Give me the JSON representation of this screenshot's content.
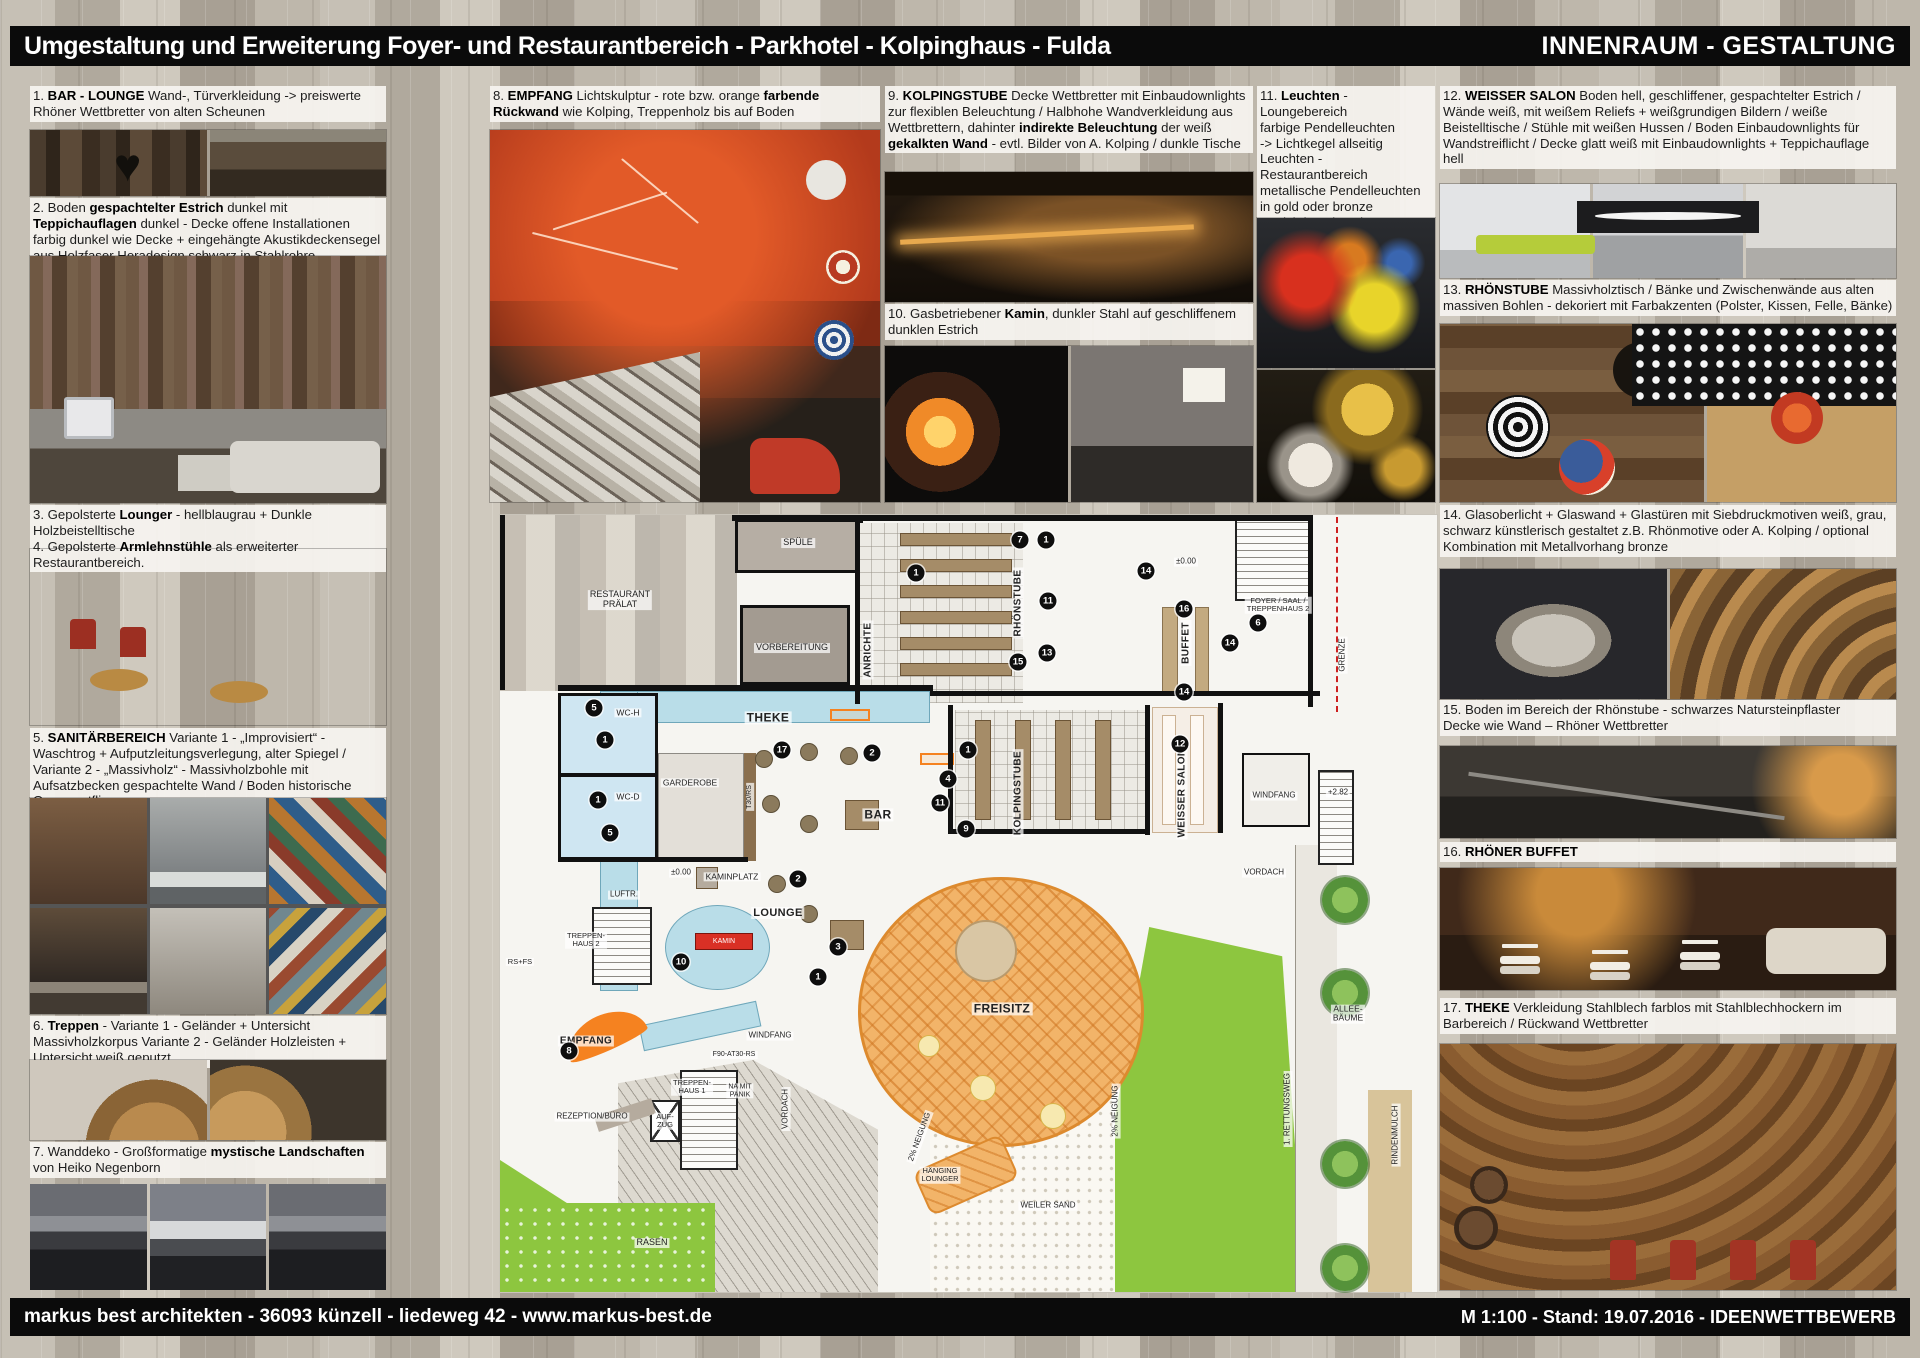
{
  "header": {
    "title": "Umgestaltung und Erweiterung Foyer- und Restaurantbereich - Parkhotel - Kolpinghaus - Fulda",
    "right_title": "INNENRAUM - GESTALTUNG"
  },
  "footer": {
    "left": "markus best architekten - 36093 künzell - liedeweg 42 - www.markus-best.de",
    "right": "M 1:100   -   Stand: 19.07.2016   -   IDEENWETTBEWERB"
  },
  "colors": {
    "accent_orange": "#f58220",
    "plan_cyan": "#b9dde8",
    "plan_green": "#8dc63f",
    "kamin_red": "#d93025",
    "marker_black": "#0e0e0e"
  },
  "annotations": [
    {
      "segments": [
        {
          "b": false,
          "t": "1. "
        },
        {
          "b": true,
          "t": "BAR - LOUNGE"
        },
        {
          "b": false,
          "t": " Wand-, Türverkleidung -> preiswerte Rhöner Wettbretter von alten Scheunen"
        }
      ]
    },
    {
      "segments": [
        {
          "b": false,
          "t": "2. Boden "
        },
        {
          "b": true,
          "t": "gespachtelter Estrich"
        },
        {
          "b": false,
          "t": " dunkel mit "
        },
        {
          "b": true,
          "t": "Teppichauflagen"
        },
        {
          "b": false,
          "t": " dunkel - Decke offene Installationen farbig dunkel wie Decke + eingehängte Akustikdeckensegel aus Holzfaser Heradesign schwarz in Stahlrohre"
        }
      ]
    },
    {
      "segments": [
        {
          "b": false,
          "t": "3. Gepolsterte "
        },
        {
          "b": true,
          "t": "Lounger"
        },
        {
          "b": false,
          "t": " - hellblaugrau + Dunkle Holzbeistelltische\n4. Gepolsterte "
        },
        {
          "b": true,
          "t": "Armlehnstühle"
        },
        {
          "b": false,
          "t": " als erweiterter Restaurantbereich."
        }
      ]
    },
    {
      "segments": [
        {
          "b": false,
          "t": "5. "
        },
        {
          "b": true,
          "t": "SANITÄRBEREICH"
        },
        {
          "b": false,
          "t": " Variante 1 - „Improvisiert“ - Waschtrog + Aufputzleitungsverlegung, alter Spiegel / Variante 2 - „Massivholz“ - Massivholzbohle mit Aufsatzbecken gespachtelte Wand / Boden historische Ornamentfliesen"
        }
      ]
    },
    {
      "segments": [
        {
          "b": false,
          "t": "6. "
        },
        {
          "b": true,
          "t": "Treppen"
        },
        {
          "b": false,
          "t": " - Variante 1 - Geländer + Untersicht Massivholzkorpus Variante 2 - Geländer Holzleisten + Untersicht weiß geputzt"
        }
      ]
    },
    {
      "segments": [
        {
          "b": false,
          "t": "7. Wanddeko - Großformatige "
        },
        {
          "b": true,
          "t": "mystische Landschaften"
        },
        {
          "b": false,
          "t": " von Heiko Negenborn"
        }
      ]
    },
    {
      "segments": [
        {
          "b": false,
          "t": "8. "
        },
        {
          "b": true,
          "t": "EMPFANG"
        },
        {
          "b": false,
          "t": " Lichtskulptur - rote bzw. orange "
        },
        {
          "b": true,
          "t": "farbende Rückwand"
        },
        {
          "b": false,
          "t": " wie Kolping, Treppenholz bis auf Boden"
        }
      ]
    },
    {
      "segments": [
        {
          "b": false,
          "t": "9. "
        },
        {
          "b": true,
          "t": "KOLPINGSTUBE"
        },
        {
          "b": false,
          "t": " Decke Wettbretter mit Einbaudownlights zur flexiblen Beleuchtung / Halbhohe Wandverkleidung aus Wettbrettern, dahinter "
        },
        {
          "b": true,
          "t": "indirekte Beleuchtung"
        },
        {
          "b": false,
          "t": " der weiß "
        },
        {
          "b": true,
          "t": "gekalkten Wand"
        },
        {
          "b": false,
          "t": " - evtl. Bilder von A. Kolping / dunkle Tische"
        }
      ]
    },
    {
      "segments": [
        {
          "b": false,
          "t": "10. Gasbetriebener "
        },
        {
          "b": true,
          "t": "Kamin"
        },
        {
          "b": false,
          "t": ", dunkler Stahl auf geschliffenem dunklen Estrich"
        }
      ]
    },
    {
      "segments": [
        {
          "b": false,
          "t": "11. "
        },
        {
          "b": true,
          "t": "Leuchten"
        },
        {
          "b": false,
          "t": " - Loungebereich\nfarbige Pendelleuchten\n-> Lichtkegel allseitig\nLeuchten - Restaurantbereich\nmetallische Pendelleuchten\nin gold oder bronze\n-> Lichtkegel nach unten"
        }
      ]
    },
    {
      "segments": [
        {
          "b": false,
          "t": "12. "
        },
        {
          "b": true,
          "t": "WEISSER SALON"
        },
        {
          "b": false,
          "t": " Boden hell, geschliffener, gespachtelter Estrich / Wände weiß, mit weißem Reliefs + weißgrundigen Bildern / weiße Beistelltische / Stühle mit weißen Hussen / Boden Einbaudownlights für Wandstreiflicht / Decke glatt weiß mit Einbaudownlights + Teppichauflage hell"
        }
      ]
    },
    {
      "segments": [
        {
          "b": false,
          "t": "13. "
        },
        {
          "b": true,
          "t": "RHÖNSTUBE"
        },
        {
          "b": false,
          "t": " Massivholztisch / Bänke und Zwischenwände aus alten massiven Bohlen - dekoriert mit Farbakzenten  (Polster, Kissen, Felle, Bänke)"
        }
      ]
    },
    {
      "segments": [
        {
          "b": false,
          "t": "14. Glasoberlicht + Glaswand + Glastüren mit Siebdruckmotiven weiß, grau, schwarz künstlerisch gestaltet  z.B. Rhönmotive oder A. Kolping / optional Kombination mit Metallvorhang bronze"
        }
      ]
    },
    {
      "segments": [
        {
          "b": false,
          "t": "15. Boden im Bereich der Rhönstube - schwarzes Natursteinpflaster\nDecke wie Wand – Rhöner Wettbretter"
        }
      ]
    },
    {
      "segments": [
        {
          "b": false,
          "t": "16. "
        },
        {
          "b": true,
          "t": "RHÖNER BUFFET"
        }
      ]
    },
    {
      "segments": [
        {
          "b": false,
          "t": "17. "
        },
        {
          "b": true,
          "t": "THEKE"
        },
        {
          "b": false,
          "t": " Verkleidung Stahlblech farblos mit Stahlblechhockern im Barbereich / Rückwand Wettbretter"
        }
      ]
    }
  ],
  "plan": {
    "labels": [
      {
        "t": "RESTAURANT\nPRÄLAT",
        "x": 120,
        "y": 85,
        "s": 9
      },
      {
        "t": "SPÜLE",
        "x": 298,
        "y": 28,
        "s": 9
      },
      {
        "t": "VORBEREITUNG",
        "x": 292,
        "y": 133,
        "s": 9
      },
      {
        "t": "ANRICHTE",
        "x": 368,
        "y": 135,
        "rot": -90,
        "s": 10,
        "b": 1
      },
      {
        "t": "RHÖNSTUBE",
        "x": 518,
        "y": 88,
        "rot": -90,
        "s": 10,
        "b": 1
      },
      {
        "t": "±0.00",
        "x": 686,
        "y": 47,
        "s": 8
      },
      {
        "t": "FOYER / SAAL /\nTREPPENHAUS 2",
        "x": 778,
        "y": 90,
        "s": 7.5
      },
      {
        "t": "BUFFET",
        "x": 686,
        "y": 128,
        "rot": -90,
        "s": 10,
        "b": 1
      },
      {
        "t": "GRENZE",
        "x": 843,
        "y": 140,
        "rot": -90,
        "s": 8
      },
      {
        "t": "WC-H",
        "x": 128,
        "y": 198,
        "s": 8.5
      },
      {
        "t": "WC-D",
        "x": 128,
        "y": 282,
        "s": 8.5
      },
      {
        "t": "GARDEROBE",
        "x": 190,
        "y": 268,
        "s": 8.5
      },
      {
        "t": "THEKE",
        "x": 268,
        "y": 203,
        "s": 12,
        "b": 1
      },
      {
        "t": "T30/RS",
        "x": 250,
        "y": 282,
        "rot": -90,
        "s": 7
      },
      {
        "t": "BAR",
        "x": 378,
        "y": 300,
        "s": 12,
        "b": 1
      },
      {
        "t": "KOLPINGSTUBE",
        "x": 518,
        "y": 278,
        "rot": -90,
        "s": 10,
        "b": 1
      },
      {
        "t": "WEISSER SALON",
        "x": 682,
        "y": 278,
        "rot": -90,
        "s": 10,
        "b": 1
      },
      {
        "t": "WINDFANG",
        "x": 774,
        "y": 281,
        "s": 8
      },
      {
        "t": "+2.82",
        "x": 838,
        "y": 278,
        "s": 8
      },
      {
        "t": "VORDACH",
        "x": 764,
        "y": 358,
        "s": 8
      },
      {
        "t": "LOUNGE",
        "x": 278,
        "y": 398,
        "s": 11,
        "b": 1
      },
      {
        "t": "KAMINPLATZ",
        "x": 232,
        "y": 362,
        "s": 8.5
      },
      {
        "t": "±0.00",
        "x": 181,
        "y": 358,
        "s": 8
      },
      {
        "t": "LUFTR.",
        "x": 124,
        "y": 380,
        "s": 8
      },
      {
        "t": "TREPPEN-\nHAUS 2",
        "x": 86,
        "y": 425,
        "s": 7.5
      },
      {
        "t": "RS+FS",
        "x": 20,
        "y": 447,
        "s": 7.5
      },
      {
        "t": "KAMIN",
        "x": 224,
        "y": 427,
        "s": 7,
        "c": "#ffffff"
      },
      {
        "t": "EMPFANG",
        "x": 86,
        "y": 526,
        "s": 10,
        "b": 1
      },
      {
        "t": "WINDFANG",
        "x": 270,
        "y": 521,
        "s": 8
      },
      {
        "t": "F90-AT30-RS",
        "x": 234,
        "y": 540,
        "s": 7
      },
      {
        "t": "TREPPEN-\nHAUS 1",
        "x": 192,
        "y": 572,
        "s": 7.5
      },
      {
        "t": "NA MIT\nPANIK",
        "x": 240,
        "y": 576,
        "s": 7
      },
      {
        "t": "REZEPTION/BÜRO",
        "x": 92,
        "y": 602,
        "s": 8
      },
      {
        "t": "AUF-\nZUG",
        "x": 165,
        "y": 606,
        "s": 7.5
      },
      {
        "t": "VORDACH",
        "x": 286,
        "y": 594,
        "rot": -90,
        "s": 8
      },
      {
        "t": "RASEN",
        "x": 152,
        "y": 728,
        "s": 9
      },
      {
        "t": "FREISITZ",
        "x": 502,
        "y": 494,
        "s": 12,
        "b": 1
      },
      {
        "t": "HÄNGING\nLOUNGER",
        "x": 440,
        "y": 660,
        "s": 7.5
      },
      {
        "t": "WEILER SAND",
        "x": 548,
        "y": 691,
        "s": 8
      },
      {
        "t": "2% NEIGUNG",
        "x": 616,
        "y": 596,
        "rot": -90,
        "s": 8
      },
      {
        "t": "2% NEIGUNG",
        "x": 420,
        "y": 622,
        "rot": -70,
        "s": 8
      },
      {
        "t": "ALLEE-\nBÄUME",
        "x": 848,
        "y": 499,
        "s": 8.5
      },
      {
        "t": "1. RETTUNGSWEG",
        "x": 788,
        "y": 594,
        "rot": -90,
        "s": 8
      },
      {
        "t": "RINDENMULCH",
        "x": 896,
        "y": 620,
        "rot": -90,
        "s": 8
      }
    ],
    "markers": [
      {
        "n": "7",
        "x": 520,
        "y": 25
      },
      {
        "n": "1",
        "x": 546,
        "y": 25
      },
      {
        "n": "14",
        "x": 646,
        "y": 56
      },
      {
        "n": "1",
        "x": 416,
        "y": 58
      },
      {
        "n": "11",
        "x": 548,
        "y": 86
      },
      {
        "n": "16",
        "x": 684,
        "y": 94
      },
      {
        "n": "6",
        "x": 758,
        "y": 108
      },
      {
        "n": "14",
        "x": 730,
        "y": 128
      },
      {
        "n": "13",
        "x": 547,
        "y": 138
      },
      {
        "n": "15",
        "x": 518,
        "y": 147
      },
      {
        "n": "14",
        "x": 684,
        "y": 177
      },
      {
        "n": "5",
        "x": 94,
        "y": 193
      },
      {
        "n": "1",
        "x": 105,
        "y": 225
      },
      {
        "n": "17",
        "x": 282,
        "y": 235
      },
      {
        "n": "2",
        "x": 372,
        "y": 238
      },
      {
        "n": "12",
        "x": 680,
        "y": 229
      },
      {
        "n": "1",
        "x": 468,
        "y": 235
      },
      {
        "n": "4",
        "x": 448,
        "y": 264
      },
      {
        "n": "1",
        "x": 98,
        "y": 285
      },
      {
        "n": "11",
        "x": 440,
        "y": 288
      },
      {
        "n": "9",
        "x": 466,
        "y": 314
      },
      {
        "n": "5",
        "x": 110,
        "y": 318
      },
      {
        "n": "2",
        "x": 298,
        "y": 364
      },
      {
        "n": "10",
        "x": 181,
        "y": 447
      },
      {
        "n": "3",
        "x": 338,
        "y": 432
      },
      {
        "n": "1",
        "x": 318,
        "y": 462
      },
      {
        "n": "8",
        "x": 69,
        "y": 536
      }
    ]
  }
}
